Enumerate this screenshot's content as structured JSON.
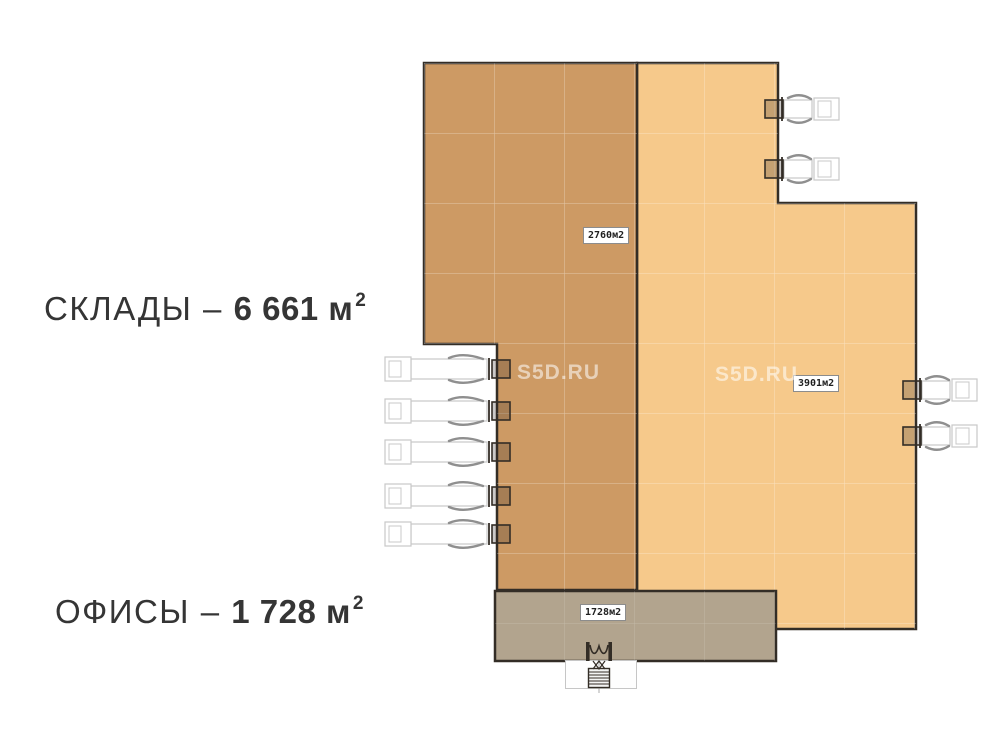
{
  "legend": {
    "warehouses": {
      "prefix": "СКЛАДЫ – ",
      "value": "6 661 м",
      "sup": "2"
    },
    "offices": {
      "prefix": "ОФИСЫ – ",
      "value": "1 728 м",
      "sup": "2"
    }
  },
  "watermarks": [
    {
      "text": "S5D.RU"
    },
    {
      "text": "S5D.RU"
    }
  ],
  "plan": {
    "colors": {
      "warehouse_dark": "#cd9a64",
      "warehouse_light": "#f6c98b",
      "office": "#b2a48e",
      "outline": "#332d26",
      "grid": "rgba(255,255,255,0.45)",
      "truck_outline": "#c8c8c8",
      "truck_detail": "#8f8f8f",
      "dock_fill": "rgba(51,45,38,0.25)"
    },
    "areas": [
      {
        "name": "warehouse-section-dark",
        "area_label": "2760м2"
      },
      {
        "name": "warehouse-section-light",
        "area_label": "3901м2"
      },
      {
        "name": "office-section",
        "area_label": "1728м2"
      }
    ],
    "docks": [
      {
        "side": "left",
        "wall_x": 497,
        "cy": 369,
        "dir": -1,
        "size": "long"
      },
      {
        "side": "left",
        "wall_x": 497,
        "cy": 411,
        "dir": -1,
        "size": "long"
      },
      {
        "side": "left",
        "wall_x": 497,
        "cy": 452,
        "dir": -1,
        "size": "long"
      },
      {
        "side": "left",
        "wall_x": 497,
        "cy": 496,
        "dir": -1,
        "size": "long"
      },
      {
        "side": "left",
        "wall_x": 497,
        "cy": 534,
        "dir": -1,
        "size": "long"
      },
      {
        "side": "top-right",
        "wall_x": 778,
        "cy": 109,
        "dir": 1,
        "size": "short"
      },
      {
        "side": "top-right",
        "wall_x": 778,
        "cy": 169,
        "dir": 1,
        "size": "short"
      },
      {
        "side": "right",
        "wall_x": 916,
        "cy": 390,
        "dir": 1,
        "size": "short"
      },
      {
        "side": "right",
        "wall_x": 916,
        "cy": 436,
        "dir": 1,
        "size": "short"
      }
    ]
  }
}
